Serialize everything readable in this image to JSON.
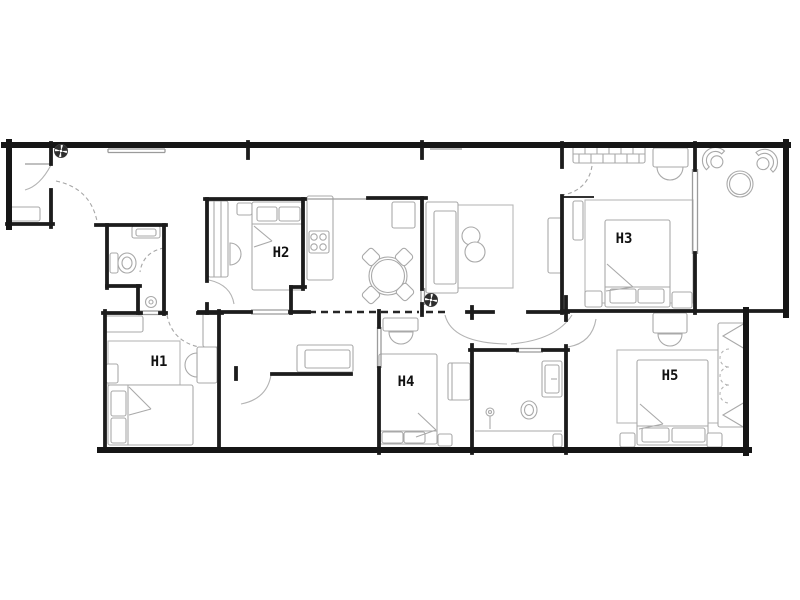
{
  "app": {
    "type": "architectural-floor-plan",
    "background_color": "#ffffff",
    "wall_color": "#1c1c1c",
    "furniture_color": "#a9a9a9",
    "label_color": "#111111"
  },
  "rooms": [
    {
      "id": "h1",
      "label": "H1",
      "x": 159,
      "y": 366
    },
    {
      "id": "h2",
      "label": "H2",
      "x": 281,
      "y": 257
    },
    {
      "id": "h3",
      "label": "H3",
      "x": 624,
      "y": 243
    },
    {
      "id": "h4",
      "label": "H4",
      "x": 406,
      "y": 386
    },
    {
      "id": "h5",
      "label": "H5",
      "x": 670,
      "y": 380
    }
  ],
  "icons": {
    "ceiling_fan_positions": [
      [
        61,
        151
      ],
      [
        431,
        300
      ]
    ]
  },
  "geometry": {
    "canvas": [
      800,
      600
    ],
    "walls_outer": [
      [
        4,
        145,
        788,
        145
      ],
      [
        9,
        142,
        9,
        227
      ],
      [
        786,
        142,
        786,
        315
      ],
      [
        746,
        310,
        746,
        453
      ],
      [
        100,
        450,
        749,
        450
      ]
    ],
    "walls": [
      [
        7,
        224,
        53,
        224
      ],
      [
        51,
        143,
        51,
        164
      ],
      [
        51,
        190,
        51,
        227
      ],
      [
        96,
        225,
        166,
        225
      ],
      [
        107,
        225,
        107,
        288
      ],
      [
        107,
        286,
        140,
        286
      ],
      [
        138,
        286,
        138,
        313
      ],
      [
        164,
        225,
        164,
        314
      ],
      [
        160,
        313,
        166,
        313
      ],
      [
        105,
        311,
        105,
        450
      ],
      [
        219,
        311,
        219,
        450
      ],
      [
        103,
        313,
        141,
        313
      ],
      [
        198,
        313,
        222,
        313
      ],
      [
        199,
        312,
        251,
        312
      ],
      [
        290,
        312,
        309,
        312
      ],
      [
        205,
        199,
        305,
        199
      ],
      [
        207,
        199,
        207,
        281
      ],
      [
        207,
        304,
        207,
        313
      ],
      [
        303,
        199,
        303,
        289
      ],
      [
        291,
        287,
        305,
        287
      ],
      [
        291,
        287,
        291,
        313
      ],
      [
        368,
        198,
        426,
        198
      ],
      [
        422,
        198,
        422,
        289
      ],
      [
        422,
        304,
        422,
        315
      ],
      [
        248,
        142,
        248,
        158
      ],
      [
        422,
        142,
        422,
        158
      ],
      [
        379,
        311,
        379,
        327
      ],
      [
        379,
        368,
        379,
        453
      ],
      [
        467,
        312,
        493,
        312
      ],
      [
        528,
        312,
        568,
        312
      ],
      [
        472,
        345,
        472,
        453
      ],
      [
        472,
        307,
        472,
        318
      ],
      [
        470,
        350,
        517,
        350
      ],
      [
        543,
        350,
        568,
        350
      ],
      [
        566,
        297,
        566,
        320
      ],
      [
        566,
        346,
        566,
        453
      ],
      [
        562,
        311,
        787,
        311
      ],
      [
        562,
        143,
        562,
        167
      ],
      [
        562,
        196,
        562,
        313
      ],
      [
        695,
        143,
        695,
        170
      ],
      [
        695,
        253,
        695,
        313
      ],
      [
        236,
        368,
        236,
        379
      ],
      [
        272,
        374,
        351,
        374
      ]
    ],
    "walls2": [
      [
        562,
        197,
        593,
        197
      ]
    ],
    "walls_thin": [
      [
        305,
        199,
        368,
        199
      ],
      [
        421,
        288,
        421,
        305
      ],
      [
        424.5,
        288,
        424.5,
        305
      ],
      [
        138,
        311,
        164,
        311
      ],
      [
        138,
        314.5,
        164,
        314.5
      ],
      [
        251,
        310,
        290,
        310
      ],
      [
        251,
        314,
        290,
        314
      ],
      [
        377.5,
        327,
        377.5,
        368
      ],
      [
        381,
        327,
        381,
        368
      ],
      [
        516,
        348.5,
        543,
        348.5
      ],
      [
        516,
        352,
        543,
        352
      ],
      [
        692.5,
        169,
        692.5,
        254
      ],
      [
        697.5,
        169,
        697.5,
        254
      ],
      [
        25,
        164,
        51,
        164
      ],
      [
        108,
        149,
        165,
        149
      ],
      [
        108,
        152.5,
        165,
        152.5
      ],
      [
        108,
        149,
        108,
        152.5
      ],
      [
        165,
        149,
        165,
        152.5
      ],
      [
        430,
        149,
        462,
        149
      ]
    ],
    "dashed_walls": [
      [
        309,
        312,
        377,
        312
      ],
      [
        381,
        312,
        419,
        312
      ],
      [
        426,
        312,
        445,
        312
      ]
    ],
    "door_arcs": [
      "M25,190 Q40,186 51,165",
      "M209,280 Q231,285 234,304",
      "M271,375 Q267,399 241,404",
      "M445,315 Q452,343 507,344",
      "M511,344 Q556,340 572,315",
      "M596,319 Q592,343 568,347"
    ],
    "door_arcs_dashed": [
      "M56,181 Q90,188 97,221",
      "M164,248 Q143,252 140,272",
      "M167,315 Q172,341 199,347",
      "M592,166 Q588,190 563,195"
    ],
    "rugs": [
      [
        108,
        341,
        72,
        44
      ],
      [
        457,
        205,
        56,
        83
      ],
      [
        585,
        200,
        108,
        103
      ],
      [
        617,
        350,
        110,
        73
      ]
    ],
    "furn_rects": [
      [
        9,
        207,
        31,
        14
      ],
      [
        132,
        226,
        28,
        12
      ],
      [
        136,
        229,
        20,
        7
      ],
      [
        110,
        253,
        8,
        20
      ],
      [
        105,
        316,
        38,
        16
      ],
      [
        106,
        364,
        12,
        19
      ],
      [
        197,
        347,
        20,
        36
      ],
      [
        203,
        313,
        16,
        34
      ],
      [
        108,
        385,
        85,
        60
      ],
      [
        111,
        391,
        15,
        25
      ],
      [
        111,
        418,
        15,
        25
      ],
      [
        208,
        201,
        20,
        76
      ],
      [
        237,
        203,
        15,
        12
      ],
      [
        252,
        202,
        51,
        88
      ],
      [
        257,
        207,
        20,
        14
      ],
      [
        279,
        207,
        21,
        14
      ],
      [
        307,
        196,
        26,
        84
      ],
      [
        309,
        231,
        20,
        22
      ],
      [
        392,
        202,
        23,
        26
      ],
      [
        426,
        202,
        32,
        91
      ],
      [
        434,
        211,
        22,
        73
      ],
      [
        548,
        218,
        15,
        55
      ],
      [
        297,
        345,
        56,
        27
      ],
      [
        305,
        350,
        45,
        18
      ],
      [
        573,
        145,
        72,
        18
      ],
      [
        653,
        148,
        35,
        19
      ],
      [
        573,
        201,
        10,
        39
      ],
      [
        605,
        220,
        65,
        87
      ],
      [
        610,
        289,
        26,
        14
      ],
      [
        638,
        289,
        26,
        14
      ],
      [
        585,
        291,
        17,
        16
      ],
      [
        672,
        292,
        20,
        16
      ],
      [
        383,
        318,
        35,
        13
      ],
      [
        379,
        354,
        58,
        90
      ],
      [
        382,
        432,
        21,
        11
      ],
      [
        404,
        432,
        21,
        11
      ],
      [
        448,
        363,
        22,
        37
      ],
      [
        438,
        434,
        14,
        12
      ],
      [
        542,
        361,
        20,
        36
      ],
      [
        545,
        365,
        14,
        28
      ],
      [
        553,
        434,
        9,
        13
      ],
      [
        637,
        360,
        71,
        85
      ],
      [
        642,
        428,
        27,
        14
      ],
      [
        672,
        428,
        33,
        14
      ],
      [
        653,
        313,
        34,
        20
      ],
      [
        620,
        433,
        15,
        14
      ],
      [
        707,
        433,
        15,
        14
      ],
      [
        718,
        323,
        28,
        104
      ]
    ],
    "furn_lines": [
      [
        214,
        201,
        214,
        277
      ],
      [
        221,
        201,
        221,
        277
      ],
      [
        252,
        224,
        303,
        224
      ],
      [
        254,
        226,
        272,
        241
      ],
      [
        272,
        241,
        254,
        247
      ],
      [
        129,
        387,
        151,
        409
      ],
      [
        151,
        409,
        129,
        415
      ],
      [
        128,
        385,
        128,
        445
      ],
      [
        605,
        287,
        670,
        287
      ],
      [
        607,
        264,
        633,
        287
      ],
      [
        633,
        287,
        606,
        291
      ],
      [
        573,
        154,
        645,
        154
      ],
      [
        585,
        145,
        585,
        154
      ],
      [
        597,
        145,
        597,
        154
      ],
      [
        609,
        145,
        609,
        154
      ],
      [
        621,
        145,
        621,
        154
      ],
      [
        633,
        145,
        633,
        154
      ],
      [
        579,
        154,
        579,
        163
      ],
      [
        591,
        154,
        591,
        163
      ],
      [
        603,
        154,
        603,
        163
      ],
      [
        615,
        154,
        615,
        163
      ],
      [
        627,
        154,
        627,
        163
      ],
      [
        639,
        154,
        639,
        163
      ],
      [
        418,
        413,
        436,
        430
      ],
      [
        436,
        430,
        416,
        437
      ],
      [
        379,
        431,
        437,
        431
      ],
      [
        452,
        363,
        452,
        400
      ],
      [
        640,
        404,
        663,
        424
      ],
      [
        663,
        424,
        639,
        429
      ],
      [
        637,
        426,
        708,
        426
      ],
      [
        475,
        431,
        562,
        431
      ],
      [
        490,
        416,
        490,
        429
      ],
      [
        551,
        379,
        557,
        379
      ]
    ],
    "furn_circles": [
      [
        314,
        237,
        3.2
      ],
      [
        323,
        237,
        3.2
      ],
      [
        314,
        247,
        3.2
      ],
      [
        323,
        247,
        3.2
      ],
      [
        388,
        276,
        19
      ],
      [
        388,
        276,
        16.5
      ],
      [
        471,
        236,
        9
      ],
      [
        475,
        252,
        10
      ],
      [
        151,
        302,
        5.5
      ],
      [
        151,
        302,
        2
      ],
      [
        740,
        184,
        13
      ],
      [
        740,
        184,
        10.5
      ],
      [
        490,
        412,
        4
      ],
      [
        490,
        412,
        1.5
      ]
    ],
    "furn_ellipses": [
      [
        127,
        263,
        9,
        10
      ],
      [
        127,
        263,
        5,
        6
      ],
      [
        529,
        410,
        8,
        9
      ],
      [
        529,
        410,
        4.5,
        5.5
      ]
    ],
    "rot_rects": [
      [
        371,
        257,
        14,
        14,
        45
      ],
      [
        404,
        257,
        14,
        14,
        45
      ],
      [
        371,
        295,
        14,
        14,
        45
      ],
      [
        405,
        292,
        14,
        14,
        45
      ]
    ],
    "furn_paths": [
      "M197,353 A12,12 0 0 0 197,377 Z",
      "M230,243 A11,11 0 0 1 230,265 Z",
      "M657,167 A13,13 0 0 0 683,167 Z",
      "M389,332 A12,12 0 0 0 413,332 Z",
      "M658,334 A12,12 0 0 0 682,334 Z"
    ],
    "open_paths": [
      "M745,323 L723,336 L745,349",
      "M745,402 L723,415 L745,428"
    ],
    "dashed_paths": [
      "M729,349 A9,9 0 0 0 729,367",
      "M729,367 A9,9 0 0 0 729,385",
      "M729,385 A9,9 0 0 0 729,403"
    ],
    "fans": [
      [
        61,
        151
      ],
      [
        431,
        300
      ]
    ],
    "fan_chairs": [
      [
        714,
        159,
        -46
      ],
      [
        766,
        161,
        49
      ]
    ]
  }
}
